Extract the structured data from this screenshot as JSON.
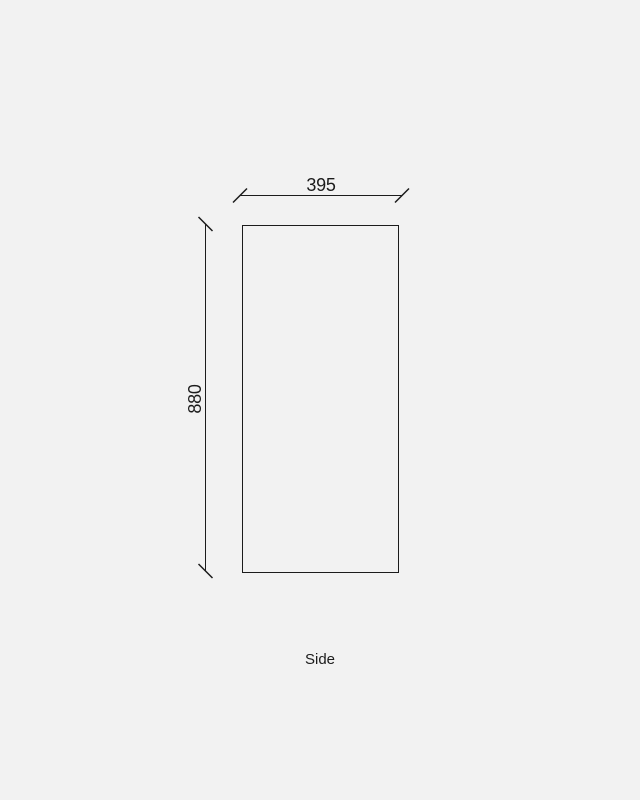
{
  "drawing": {
    "view_label": "Side",
    "dimensions": {
      "width": "395",
      "height": "880"
    },
    "colors": {
      "background": "#f2f2f2",
      "line": "#1c1c1c",
      "text": "#1c1c1c"
    }
  }
}
